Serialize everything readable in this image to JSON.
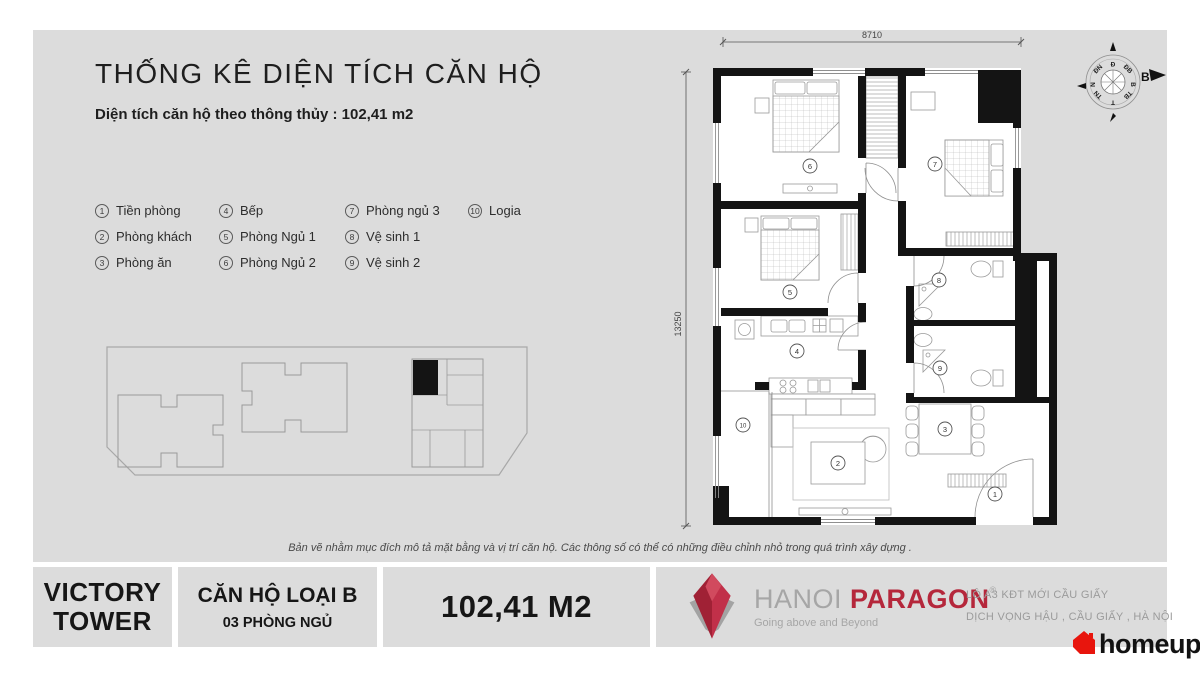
{
  "header": {
    "title": "THỐNG KÊ DIỆN TÍCH CĂN HỘ",
    "subtitle": "Diện tích căn hộ theo thông thủy : 102,41 m2"
  },
  "legend": {
    "items": [
      {
        "num": "1",
        "label": "Tiền phòng"
      },
      {
        "num": "2",
        "label": "Phòng khách"
      },
      {
        "num": "3",
        "label": "Phòng ăn"
      },
      {
        "num": "4",
        "label": "Bếp"
      },
      {
        "num": "5",
        "label": "Phòng Ngủ 1"
      },
      {
        "num": "6",
        "label": "Phòng Ngủ 2"
      },
      {
        "num": "7",
        "label": "Phòng ngủ 3"
      },
      {
        "num": "8",
        "label": "Vệ sinh 1"
      },
      {
        "num": "9",
        "label": "Vệ sinh 2"
      },
      {
        "num": "10",
        "label": "Logia"
      }
    ]
  },
  "plan": {
    "dim_top": "8710",
    "dim_left": "13250",
    "rooms": [
      "1",
      "2",
      "3",
      "4",
      "5",
      "6",
      "7",
      "8",
      "9",
      "10"
    ],
    "compass": {
      "north_label": "B",
      "ring": [
        "B",
        "ĐB",
        "Đ",
        "ĐN",
        "N",
        "TN",
        "T",
        "TB"
      ]
    }
  },
  "disclaimer": "Bản vẽ nhằm mục đích mô tả mặt bằng và vị trí căn hộ. Các thông số có thể có những điều chỉnh nhỏ trong quá trình xây dựng .",
  "footer": {
    "tower": {
      "line1": "VICTORY",
      "line2": "TOWER"
    },
    "apartment": {
      "type": "CĂN HỘ LOẠI B",
      "bedrooms": "03 PHÒNG NGỦ"
    },
    "area": "102,41 M2",
    "brand": {
      "name_first": "HANOI",
      "name_second": "PARAGON",
      "registered": "®",
      "tagline": "Going above and Beyond"
    },
    "address": {
      "line1": "LÔ A3 KĐT MỚI CẦU GIẤY",
      "line2": "DỊCH VỌNG HẬU , CẦU GIẤY , HÀ NỘI"
    },
    "homeup": "homeup"
  },
  "colors": {
    "bg": "#dcdcdc",
    "wall": "#141414",
    "accent_red": "#b5273b",
    "homeup_red": "#e8150d",
    "text_gray": "#9b9b9b"
  }
}
